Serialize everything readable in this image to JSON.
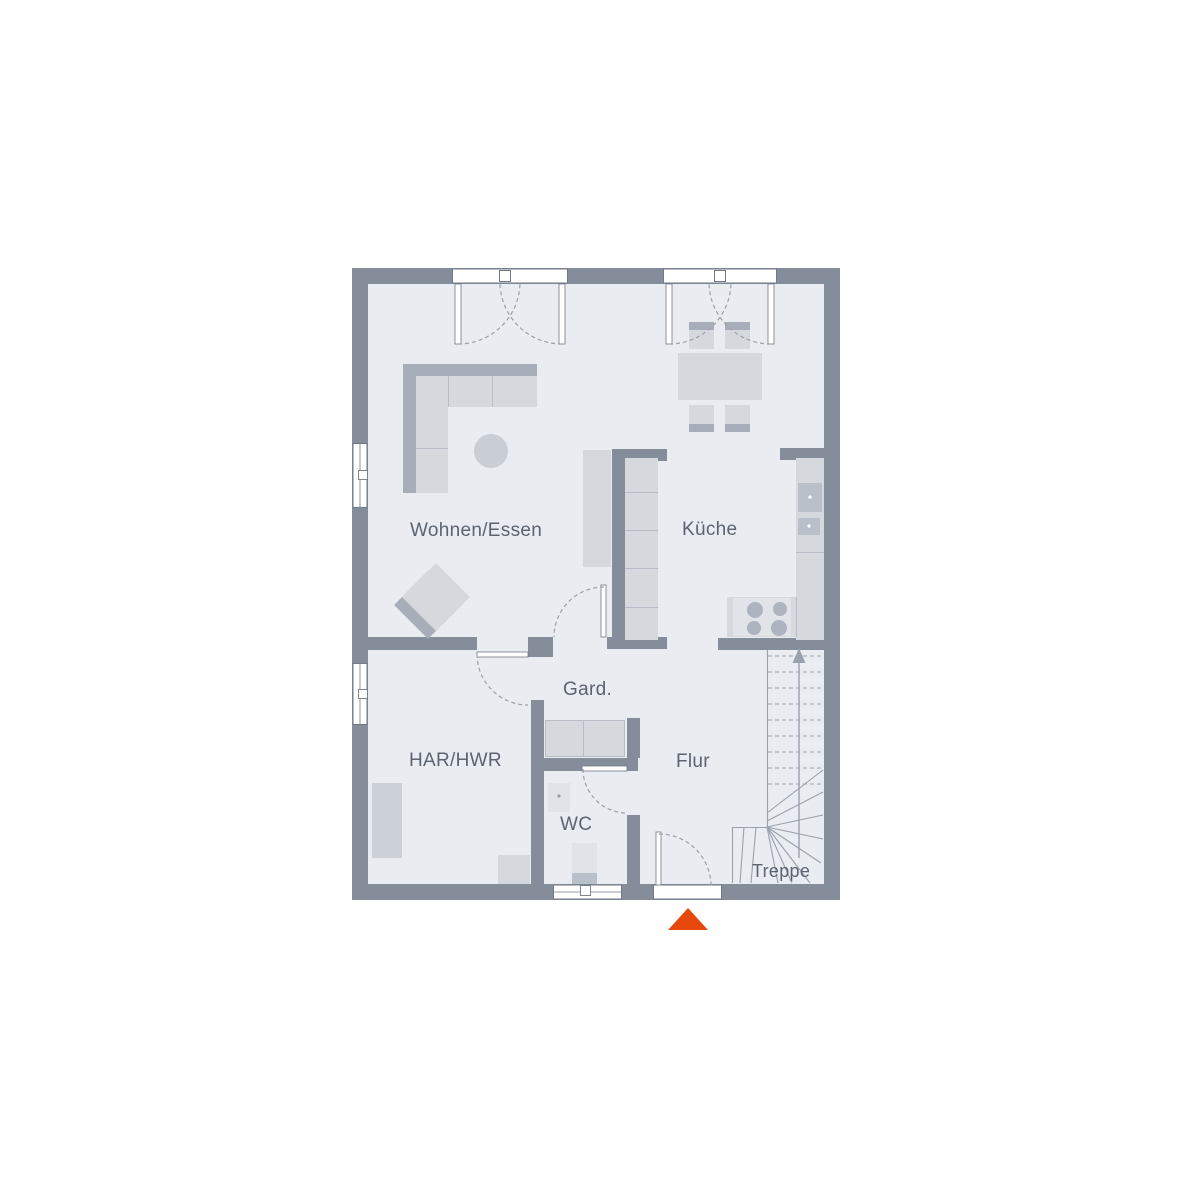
{
  "plan": {
    "type": "floor-plan",
    "rooms": [
      {
        "id": "wohnen-essen",
        "label": "Wohnen/Essen"
      },
      {
        "id": "kueche",
        "label": "Küche"
      },
      {
        "id": "gard",
        "label": "Gard."
      },
      {
        "id": "har-hwr",
        "label": "HAR/HWR"
      },
      {
        "id": "wc",
        "label": "WC"
      },
      {
        "id": "flur",
        "label": "Flur"
      },
      {
        "id": "treppe",
        "label": "Treppe"
      }
    ],
    "colors": {
      "wall": "#848d99",
      "floor": "#e9ecf0",
      "furniture_light": "#d5d9de",
      "furniture_medium": "#c9ced5",
      "furniture_dark": "#a7aeb9",
      "appliance": "#b9c0c9",
      "plan_line": "#99a1ac",
      "label_text": "#5b6470",
      "entrance_accent": "#e7480e"
    },
    "icons": [
      {
        "name": "stairs-up-arrow"
      },
      {
        "name": "entrance-arrow"
      }
    ]
  }
}
